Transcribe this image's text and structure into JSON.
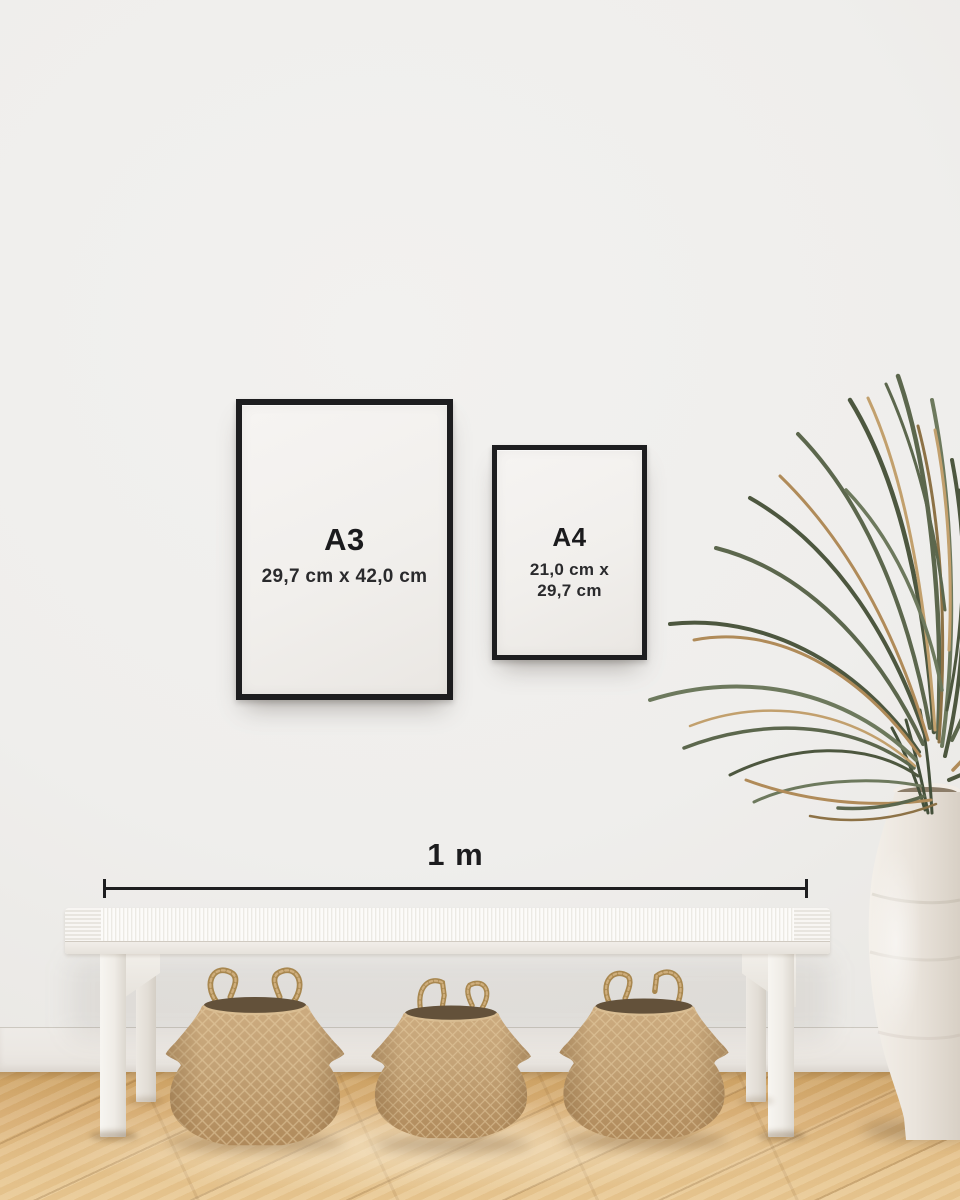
{
  "scene": {
    "description": "Poster frame size guide mockup: A3 and A4 black frames on a white wall above a white woven bench with three seagrass belly baskets, dried palm fronds in a white ceramic urn, wooden floor, and a 1 m scale bar",
    "colors": {
      "wall": "#efeeec",
      "baseboard": "#ebe7e2",
      "floor_wood": "#ddb47c",
      "frame_black": "#1d1d1f",
      "paper": "#f2f0ed",
      "text": "#1c1c1e",
      "bench_white": "#f3f1ec",
      "basket_tan": "#c4a276",
      "basket_opening": "#63513a",
      "vase_white": "#ebe6df",
      "plant_green": "#57624a",
      "plant_tan": "#b18c5a"
    }
  },
  "frames": {
    "a3": {
      "label": "A3",
      "size": "29,7 cm x 42,0 cm"
    },
    "a4": {
      "label": "A4",
      "size_line1": "21,0 cm x",
      "size_line2": "29,7 cm"
    }
  },
  "scale_bar": {
    "label": "1 m"
  }
}
